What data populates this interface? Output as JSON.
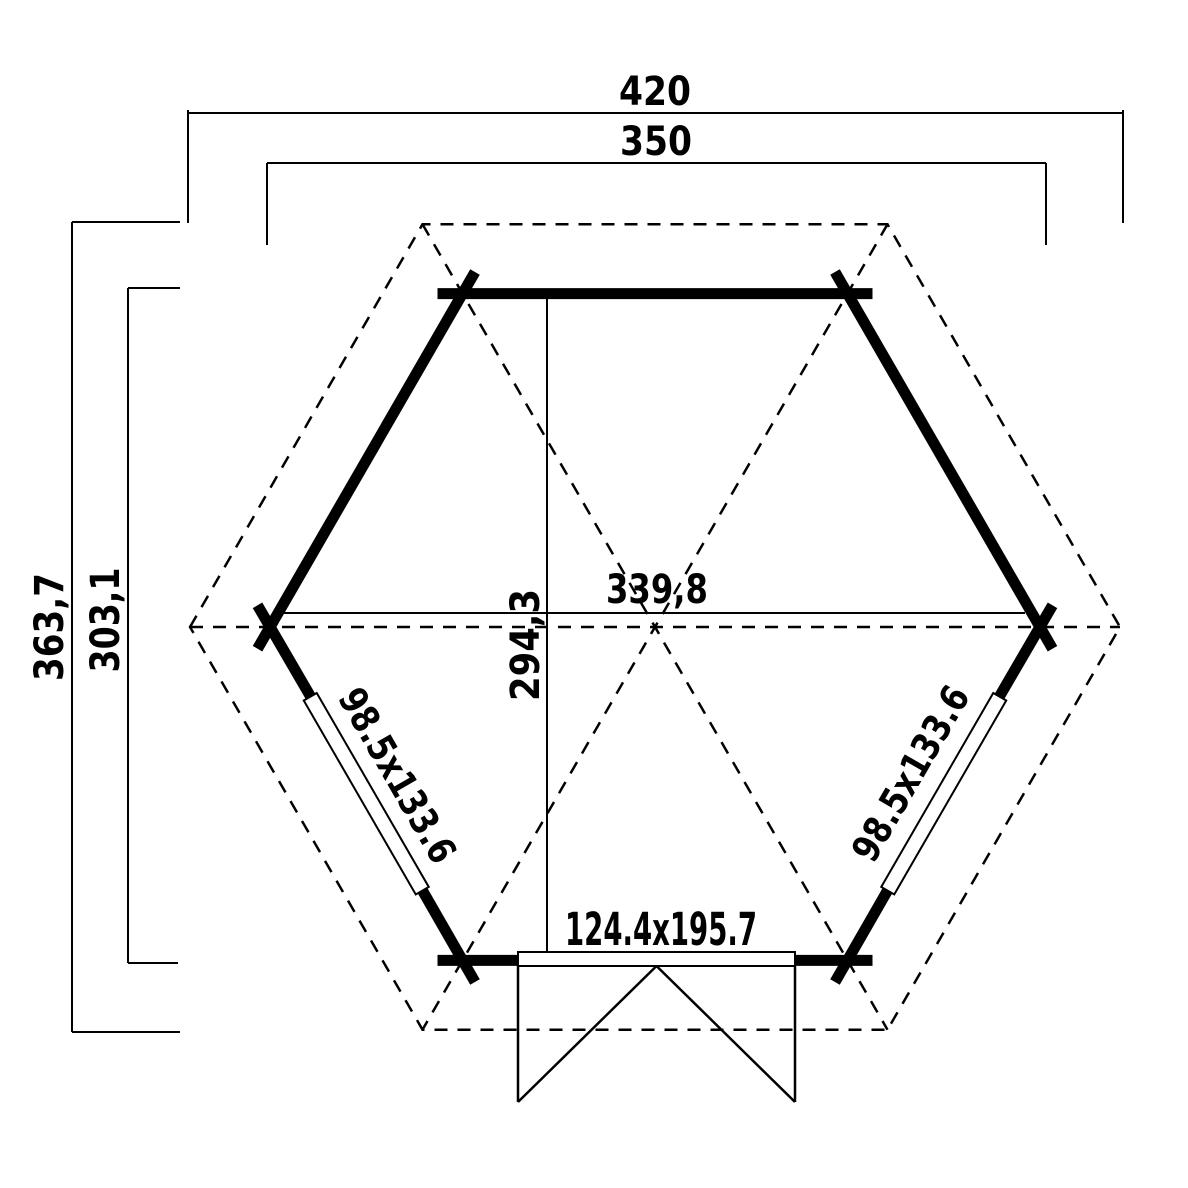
{
  "page": {
    "background": "#ffffff",
    "ink": "#000000",
    "drawing_type": "hexagonal gazebo floor plan"
  },
  "plan": {
    "dim_roof_width": "420",
    "dim_wall_width": "350",
    "dim_roof_depth": "363,7",
    "dim_wall_depth": "303,1",
    "dim_inner_width": "339,8",
    "dim_inner_depth": "294,3",
    "window_left_size": "98.5x133.6",
    "window_right_size": "98.5x133.6",
    "door_size": "124.4x195.7"
  }
}
